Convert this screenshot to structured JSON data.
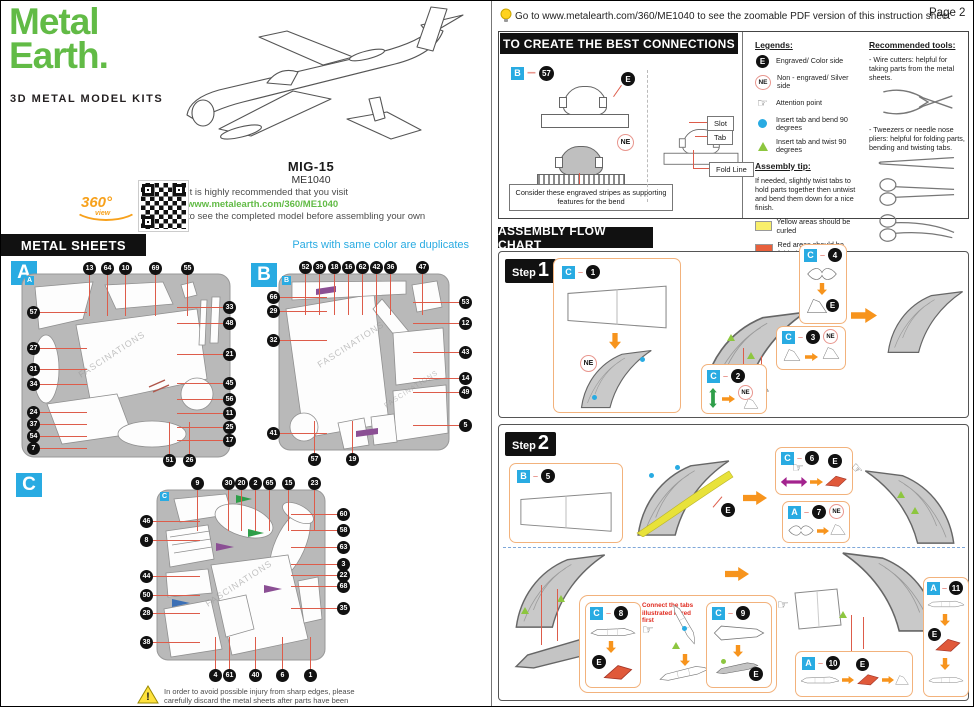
{
  "page": {
    "label": "Page 2"
  },
  "tip_bar": {
    "text": "Go to www.metalearth.com/360/ME1040 to see the zoomable PDF version of this instruction sheet"
  },
  "brand": {
    "logo_top": "Metal",
    "logo_bottom": "Earth.",
    "tagline": "3D METAL MODEL KITS"
  },
  "model": {
    "name": "MIG-15",
    "sku": "ME1040",
    "visit_line1": "It is highly recommended that you visit",
    "visit_url": "www.metalearth.com/360/ME1040",
    "visit_line2": "to see the completed model before assembling your own",
    "badge_360": "360°",
    "badge_view": "view"
  },
  "watermark": "FASCINATIONS",
  "metal_sheets": {
    "title": "METAL SHEETS",
    "note": "Parts with same color are duplicates",
    "sheets": [
      {
        "letter": "A",
        "top": [
          "13",
          "64",
          "10",
          "69",
          "55"
        ],
        "right": [
          "33",
          "48",
          "21",
          "45",
          "56",
          "11",
          "25",
          "17"
        ],
        "left": [
          "57",
          "27",
          "31",
          "34",
          "24",
          "37",
          "54",
          "7"
        ],
        "bottom": [
          "51",
          "26"
        ]
      },
      {
        "letter": "B",
        "top": [
          "52",
          "39",
          "18",
          "16",
          "62",
          "42",
          "36",
          "47"
        ],
        "right": [
          "53",
          "12",
          "43",
          "14",
          "49",
          "5"
        ],
        "left": [
          "66",
          "29",
          "32",
          "41"
        ],
        "bottom": [
          "57",
          "19"
        ]
      },
      {
        "letter": "C",
        "top": [
          "9",
          "30",
          "20",
          "2",
          "65",
          "15",
          "23"
        ],
        "right": [
          "60",
          "58",
          "63",
          "3",
          "22",
          "68",
          "35"
        ],
        "left": [
          "46",
          "8",
          "44",
          "50",
          "28",
          "38"
        ],
        "bottom": [
          "4",
          "61",
          "40",
          "6",
          "1"
        ]
      }
    ]
  },
  "connections": {
    "title": "TO CREATE THE BEST CONNECTIONS",
    "example_sheet": "B",
    "example_part": "57",
    "note": "Consider these engraved stripes as supporting features for the bend",
    "labels": {
      "slot": "Slot",
      "tab": "Tab",
      "fold_line": "Fold Line"
    }
  },
  "badges": {
    "e": "E",
    "ne": "NE"
  },
  "legends": {
    "title": "Legends:",
    "items": [
      {
        "icon": "engraved-badge-icon",
        "text": "Engraved/ Color side"
      },
      {
        "icon": "non-engraved-badge-icon",
        "text": "Non - engraved/ Silver side"
      },
      {
        "icon": "attention-hand-icon",
        "text": "Attention point"
      },
      {
        "icon": "bend-dot-icon",
        "text": "Insert tab and bend 90 degrees"
      },
      {
        "icon": "twist-triangle-icon",
        "text": "Insert tab and twist 90 degrees"
      }
    ],
    "assembly_tip_title": "Assembly tip:",
    "assembly_tip_text": "If needed, slightly twist tabs to hold parts together then untwist and bend them down for a nice finish.",
    "yellow_note": "Yellow areas should be curled",
    "red_note": "Red areas should be folded"
  },
  "tools": {
    "title": "Recommended tools:",
    "wire_cutters": "- Wire cutters: helpful for taking parts from the metal sheets.",
    "tweezers": "- Tweezers or needle nose pliers: helpful for folding parts, bending and twisting tabs."
  },
  "flow_chart": {
    "title": "ASSEMBLY FLOW CHART",
    "steps": [
      {
        "label": "Step",
        "number": "1",
        "boxes": [
          {
            "sheet": "C",
            "part": "1"
          },
          {
            "sheet": "C",
            "part": "2"
          },
          {
            "sheet": "C",
            "part": "3"
          },
          {
            "sheet": "C",
            "part": "4"
          }
        ]
      },
      {
        "label": "Step",
        "number": "2",
        "red_note": "Connect the tabs illustrated in red first",
        "boxes": [
          {
            "sheet": "B",
            "part": "5"
          },
          {
            "sheet": "C",
            "part": "6"
          },
          {
            "sheet": "A",
            "part": "7"
          },
          {
            "sheet": "C",
            "part": "8"
          },
          {
            "sheet": "C",
            "part": "9"
          },
          {
            "sheet": "A",
            "part": "10"
          },
          {
            "sheet": "A",
            "part": "11"
          }
        ]
      }
    ]
  },
  "warning": {
    "text": "In order to avoid possible injury from sharp edges, please carefully discard the metal sheets after parts have been removed."
  }
}
